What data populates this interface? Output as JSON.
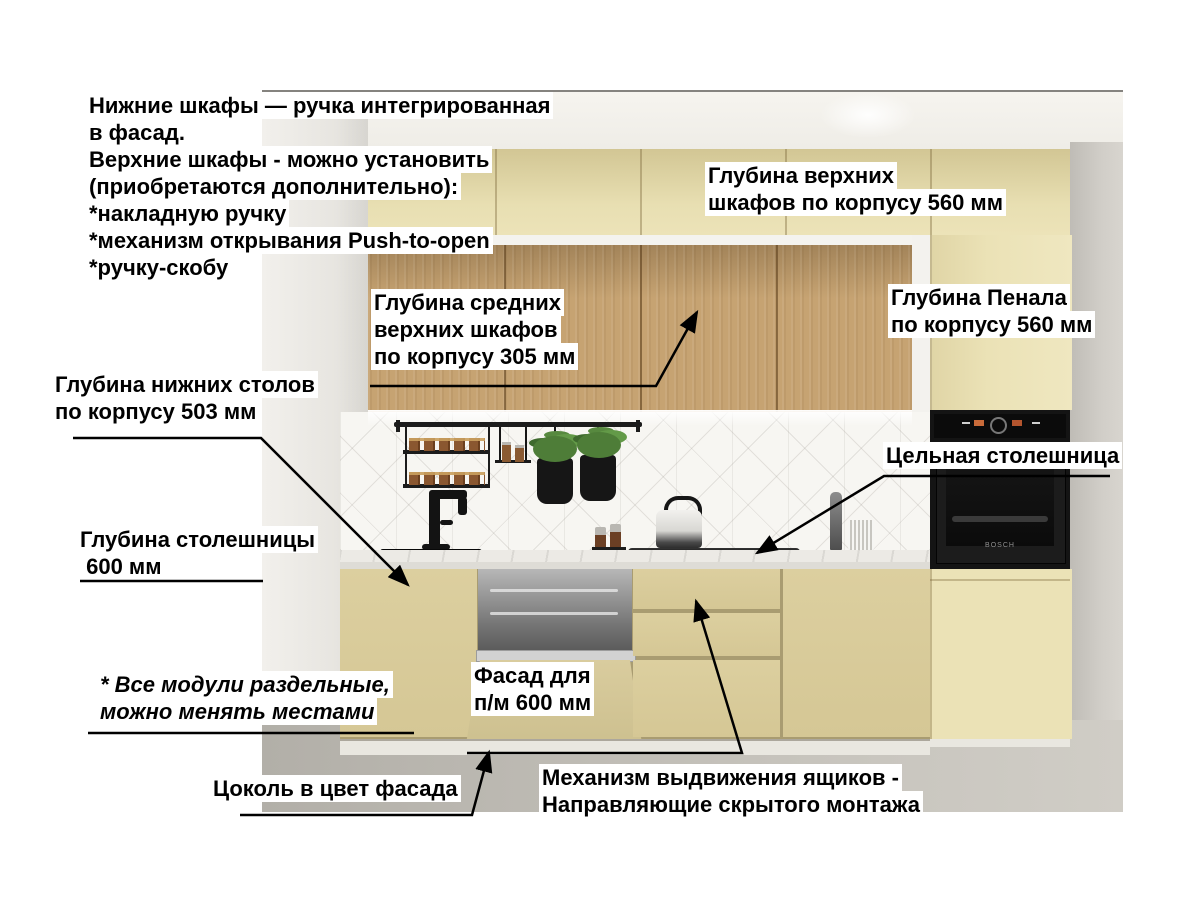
{
  "annotations": {
    "intro": {
      "l1": "Нижние шкафы — ручка интегрированная",
      "l2": "в фасад.",
      "l3": "Верхние шкафы - можно установить",
      "l4": "(приобретаются дополнительно):",
      "l5": "*накладную ручку",
      "l6": "*механизм открывания Push-to-open",
      "l7": "*ручку-скобу"
    },
    "upper_depth": {
      "l1": "Глубина верхних",
      "l2": "шкафов по корпусу 560 мм"
    },
    "mid_depth": {
      "l1": "Глубина средних",
      "l2": "верхних шкафов",
      "l3": "по корпусу 305 мм"
    },
    "tall_depth": {
      "l1": "Глубина Пенала",
      "l2": "по корпусу 560 мм"
    },
    "base_depth": {
      "l1": "Глубина нижних столов",
      "l2": "по корпусу 503 мм"
    },
    "solid_top": {
      "l1": "Цельная столешница"
    },
    "counter_depth": {
      "l1": "Глубина столешницы",
      "l2": " 600 мм"
    },
    "modules_note": {
      "l1": "* Все модули раздельные,",
      "l2": "можно менять местами"
    },
    "dw_facade": {
      "l1": "Фасад для",
      "l2": "п/м 600 мм"
    },
    "plinth": {
      "l1": "Цоколь в цвет фасада"
    },
    "drawer_mech": {
      "l1": "Механизм выдвижения ящиков -",
      "l2": "Направляющие скрытого монтажа"
    }
  },
  "appliances": {
    "oven_brand": "BOSCH"
  },
  "colors": {
    "facade_beige": "#dccf9f",
    "facade_dark": "#a99c71",
    "upper_beige_top": "#d2c694",
    "upper_beige": "#e8dfb2",
    "tall_beige": "#ebe2b6",
    "wood": "#c6a372",
    "splash": "#f7f6f2",
    "counter": "#eceae5",
    "appliance_black": "#141414",
    "plinth_white": "#e9e7e0",
    "floor_left": "#b2afa8",
    "floor_right": "#d0cdc6",
    "label_bg": "#ffffff",
    "annotation_text": "#000000"
  }
}
